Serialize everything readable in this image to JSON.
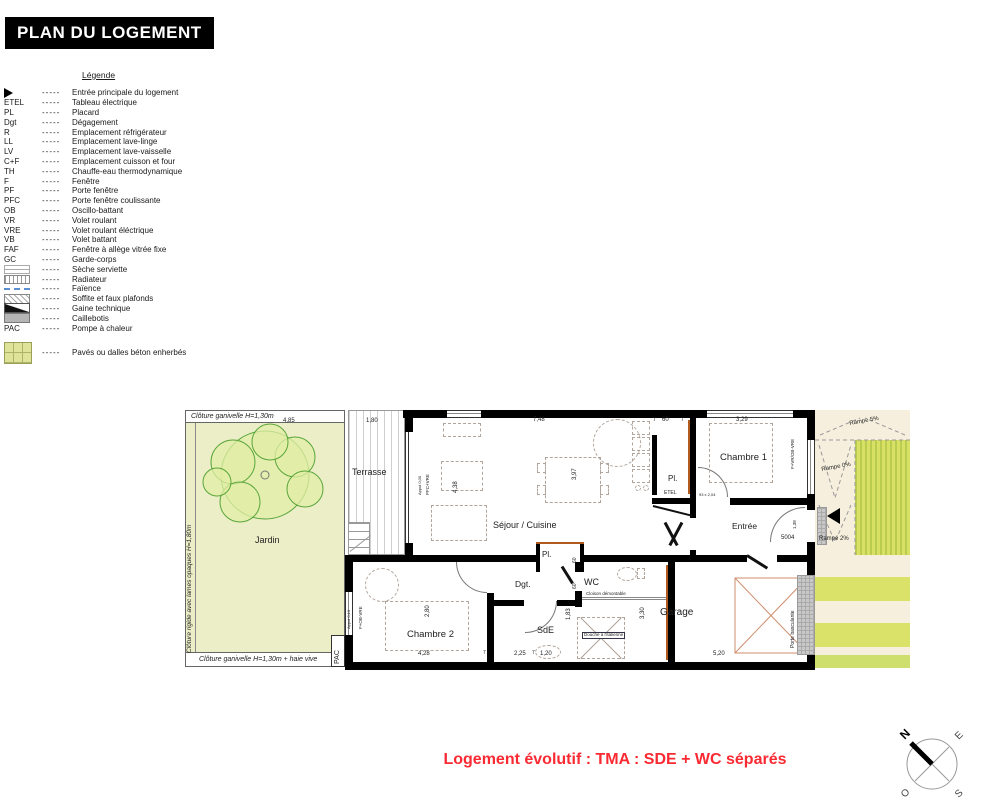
{
  "title": "PLAN DU LOGEMENT",
  "legend": {
    "heading": "Légende",
    "separator": "-----",
    "items": [
      {
        "abbr": "",
        "icon": "entry-arrow",
        "label": "Entrée principale du logement"
      },
      {
        "abbr": "ETEL",
        "icon": "",
        "label": "Tableau électrique"
      },
      {
        "abbr": "PL",
        "icon": "",
        "label": "Placard"
      },
      {
        "abbr": "Dgt",
        "icon": "",
        "label": "Dégagement"
      },
      {
        "abbr": "R",
        "icon": "",
        "label": "Emplacement réfrigérateur"
      },
      {
        "abbr": "LL",
        "icon": "",
        "label": "Emplacement lave-linge"
      },
      {
        "abbr": "LV",
        "icon": "",
        "label": "Emplacement lave-vaisselle"
      },
      {
        "abbr": "C+F",
        "icon": "",
        "label": "Emplacement cuisson et four"
      },
      {
        "abbr": "TH",
        "icon": "",
        "label": "Chauffe-eau thermodynamique"
      },
      {
        "abbr": "F",
        "icon": "",
        "label": "Fenêtre"
      },
      {
        "abbr": "PF",
        "icon": "",
        "label": "Porte fenêtre"
      },
      {
        "abbr": "PFC",
        "icon": "",
        "label": "Porte fenêtre coulissante"
      },
      {
        "abbr": "OB",
        "icon": "",
        "label": "Oscillo-battant"
      },
      {
        "abbr": "VR",
        "icon": "",
        "label": "Volet roulant"
      },
      {
        "abbr": "VRE",
        "icon": "",
        "label": "Volet roulant éléctrique"
      },
      {
        "abbr": "VB",
        "icon": "",
        "label": "Volet battant"
      },
      {
        "abbr": "FAF",
        "icon": "",
        "label": "Fenêtre à allège vitrée fixe"
      },
      {
        "abbr": "GC",
        "icon": "",
        "label": "Garde-corps"
      },
      {
        "abbr": "",
        "icon": "seche-serviette",
        "label": "Sèche serviette"
      },
      {
        "abbr": "",
        "icon": "radiateur",
        "label": "Radiateur"
      },
      {
        "abbr": "",
        "icon": "faience",
        "label": "Faïence"
      },
      {
        "abbr": "",
        "icon": "soffite",
        "label": "Soffite et faux plafonds"
      },
      {
        "abbr": "",
        "icon": "gaine",
        "label": "Gaine technique"
      },
      {
        "abbr": "",
        "icon": "caillebotis",
        "label": "Caillebotis"
      },
      {
        "abbr": "PAC",
        "icon": "",
        "label": "Pompe à chaleur"
      },
      {
        "abbr": "",
        "icon": "paves",
        "label": "Pavés ou dalles béton enherbés"
      }
    ]
  },
  "plan": {
    "colors": {
      "garden": "#ebeec6",
      "ramp_beige": "#f6efdd",
      "stripe_green": "#dbe26a",
      "faience_orange": "#b35a1f",
      "garage_cross": "#cf8e6e"
    },
    "labels": [
      {
        "name": "fence-label-top",
        "text": "Clôture ganivelle H=1,30m",
        "x": 6,
        "y": 8,
        "size": 7,
        "italic": true
      },
      {
        "name": "fence-label-left",
        "text": "Clôture rigide avec lames opaques H=1,80m",
        "x": 2,
        "y": 248,
        "size": 6.5,
        "italic": true,
        "rot": -90
      },
      {
        "name": "fence-label-bottom",
        "text": "Clôture ganivelle H=1,30m + haie vive",
        "x": 14,
        "y": 251,
        "size": 7,
        "italic": true
      },
      {
        "name": "room-label-jardin",
        "text": "Jardin",
        "x": 70,
        "y": 131,
        "size": 9
      },
      {
        "name": "room-label-terrasse",
        "text": "Terrasse",
        "x": 167,
        "y": 63,
        "size": 9
      },
      {
        "name": "room-label-sejour",
        "text": "Séjour / Cuisine",
        "x": 308,
        "y": 116,
        "size": 9
      },
      {
        "name": "room-label-chambre1",
        "text": "Chambre 1",
        "x": 535,
        "y": 48,
        "size": 9.5
      },
      {
        "name": "room-label-entree",
        "text": "Entrée",
        "x": 547,
        "y": 117,
        "size": 8.5
      },
      {
        "name": "room-label-chambre2",
        "text": "Chambre 2",
        "x": 222,
        "y": 225,
        "size": 9.5
      },
      {
        "name": "room-label-dgt",
        "text": "Dgt.",
        "x": 330,
        "y": 175,
        "size": 8.5
      },
      {
        "name": "room-label-wc",
        "text": "WC",
        "x": 399,
        "y": 173,
        "size": 9
      },
      {
        "name": "room-label-sde",
        "text": "SdE",
        "x": 352,
        "y": 221,
        "size": 9
      },
      {
        "name": "room-label-garage",
        "text": "Garage",
        "x": 475,
        "y": 203,
        "size": 10
      },
      {
        "name": "room-label-pl1",
        "text": "Pl.",
        "x": 483,
        "y": 70,
        "size": 8
      },
      {
        "name": "label-etel",
        "text": "ETEL",
        "x": 479,
        "y": 86,
        "size": 5
      },
      {
        "name": "room-label-pl2",
        "text": "Pl.",
        "x": 357,
        "y": 146,
        "size": 8
      },
      {
        "name": "label-pac",
        "text": "PAC",
        "x": 149,
        "y": 259,
        "size": 7,
        "rot": -90
      },
      {
        "name": "ramp-label-5",
        "text": "Rampe 5%",
        "x": 664,
        "y": 16,
        "size": 6,
        "rot": -10
      },
      {
        "name": "ramp-label-0",
        "text": "Rampe 0%",
        "x": 636,
        "y": 62,
        "size": 6,
        "rot": -10
      },
      {
        "name": "ramp-label-2",
        "text": "Rampé 2%",
        "x": 634,
        "y": 131,
        "size": 6
      },
      {
        "name": "label-porte-basculante",
        "text": "Porte basculante",
        "x": 606,
        "y": 243,
        "size": 5,
        "rot": -90
      },
      {
        "name": "label-cloison-demontable",
        "text": "Cloison démontable",
        "x": 401,
        "y": 187,
        "size": 4.5
      },
      {
        "name": "label-douche-italienne",
        "text": "Douche à l'italienne",
        "x": 397,
        "y": 227,
        "size": 4.5,
        "chip": true
      },
      {
        "name": "label-5004",
        "text": "5004",
        "x": 596,
        "y": 130,
        "size": 6
      },
      {
        "name": "window-tag-sejour-appui",
        "text": "Appui 0,00",
        "x": 233,
        "y": 90,
        "size": 4,
        "rot": -90
      },
      {
        "name": "window-tag-sejour-pfc",
        "text": "PFC+VRE",
        "x": 241,
        "y": 90,
        "size": 4.5,
        "rot": -90
      },
      {
        "name": "window-tag-ch2-appui",
        "text": "Appui 0,10",
        "x": 162,
        "y": 224,
        "size": 4,
        "rot": -90
      },
      {
        "name": "window-tag-ch2-f",
        "text": "F+OB-VRE",
        "x": 174,
        "y": 224,
        "size": 4.5,
        "rot": -90
      },
      {
        "name": "window-tag-ch1",
        "text": "F+VR/OB-VRE",
        "x": 606,
        "y": 64,
        "size": 4.5,
        "rot": -90
      },
      {
        "name": "door-size-tag",
        "text": "93 x 2,04",
        "x": 514,
        "y": 88,
        "size": 4
      },
      {
        "name": "dim-4-85",
        "text": "4,85",
        "x": 98,
        "y": 13,
        "size": 6
      },
      {
        "name": "dim-1-80",
        "text": "1,80",
        "x": 181,
        "y": 13,
        "size": 6
      },
      {
        "name": "dim-7-48",
        "text": "7,48",
        "x": 348,
        "y": 12,
        "size": 6
      },
      {
        "name": "dim-7-a",
        "text": "7",
        "x": 468,
        "y": 13,
        "size": 5
      },
      {
        "name": "dim-60-top",
        "text": "60",
        "x": 477,
        "y": 12,
        "size": 6
      },
      {
        "name": "dim-7-b",
        "text": "7",
        "x": 496,
        "y": 13,
        "size": 5
      },
      {
        "name": "dim-3-29",
        "text": "3,29",
        "x": 551,
        "y": 12,
        "size": 6
      },
      {
        "name": "dim-3-97",
        "text": "3,97",
        "x": 387,
        "y": 75,
        "size": 6,
        "rot": -90
      },
      {
        "name": "dim-4-38",
        "text": "4,38",
        "x": 268,
        "y": 88,
        "size": 6,
        "rot": -90
      },
      {
        "name": "dim-2-80",
        "text": "2,80",
        "x": 240,
        "y": 212,
        "size": 6,
        "rot": -90
      },
      {
        "name": "dim-4-28",
        "text": "4,28",
        "x": 233,
        "y": 246,
        "size": 6
      },
      {
        "name": "dim-7-c",
        "text": "7",
        "x": 298,
        "y": 246,
        "size": 5
      },
      {
        "name": "dim-2-25",
        "text": "2,25",
        "x": 329,
        "y": 246,
        "size": 6
      },
      {
        "name": "dim-7-d",
        "text": "7",
        "x": 347,
        "y": 246,
        "size": 5
      },
      {
        "name": "dim-1-20",
        "text": "1,20",
        "x": 355,
        "y": 246,
        "size": 6
      },
      {
        "name": "dim-1-83",
        "text": "1,83",
        "x": 381,
        "y": 215,
        "size": 6,
        "rot": -90
      },
      {
        "name": "dim-60-a",
        "text": "60",
        "x": 388,
        "y": 158,
        "size": 5,
        "rot": -90
      },
      {
        "name": "dim-60-b",
        "text": "60",
        "x": 388,
        "y": 184,
        "size": 5,
        "rot": -90
      },
      {
        "name": "dim-3-30",
        "text": "3,30",
        "x": 455,
        "y": 214,
        "size": 6,
        "rot": -90
      },
      {
        "name": "dim-5-20",
        "text": "5,20",
        "x": 528,
        "y": 246,
        "size": 6
      },
      {
        "name": "dim-1-38",
        "text": "1,38",
        "x": 608,
        "y": 124,
        "size": 4.5,
        "rot": -90
      }
    ]
  },
  "footer": {
    "note": "Logement évolutif : TMA : SDE + WC séparés",
    "color": "#fa2a33"
  },
  "compass": {
    "n": "N",
    "e": "E",
    "s": "S",
    "o": "O"
  }
}
